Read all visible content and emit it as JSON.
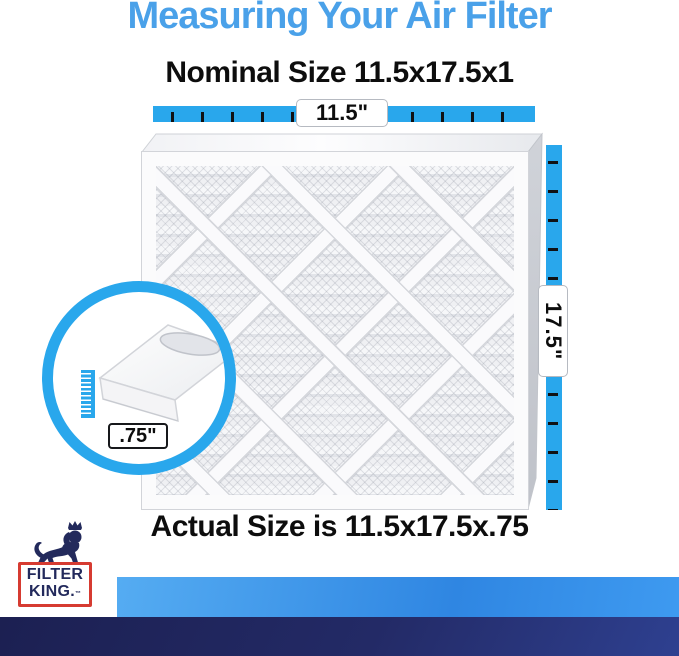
{
  "header": {
    "title": "Measuring Your Air Filter",
    "nominal_size": "Nominal Size 11.5x17.5x1"
  },
  "measurements": {
    "width": "11.5\"",
    "height": "17.5\"",
    "depth": ".75\""
  },
  "footer": {
    "actual_size": "Actual Size is 11.5x17.5x.75"
  },
  "logo": {
    "line1": "FILTER",
    "line2": "KING.",
    "trademark": "™"
  },
  "colors": {
    "accent_blue": "#29a7ec",
    "title_blue": "#4aa1e9",
    "brand_navy": "#232a5c",
    "brand_red": "#d63b31",
    "ink": "#0d0d0d"
  }
}
